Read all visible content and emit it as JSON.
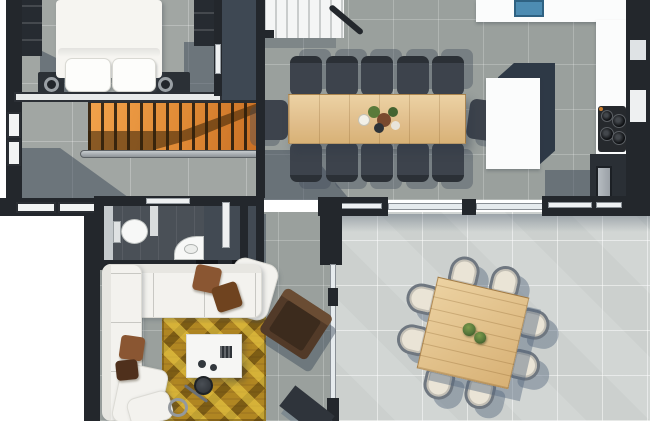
{
  "image": {
    "kind": "architectural-floor-plan-render",
    "view": "top-down",
    "description": "Open-plan home level rendered from above: bedroom, orange staircase, long dining table, kitchen, bathroom, living room with gold rug, and a bright great room with a square table."
  },
  "colors": {
    "outside": "#ffffff",
    "wall": "#23272c",
    "floor_concrete": "#a1a6a3",
    "floor_tile_gray": "#9aa09d",
    "floor_tile_light": "#d2d6d4",
    "floor_slate": "#3e4853",
    "shadow_slate": "rgba(55,67,83,0.5)",
    "stair_wood": "#e08a35",
    "white_stairs": "#f4f5f5",
    "table_wood": "#e0bd8a",
    "chair_dark": "#3d434c",
    "chair_cream": "#eae4d6",
    "chair_frame": "#6f7780",
    "sofa": "#f3f2ee",
    "pillow_brown": "#8a5632",
    "pillow_dark_brown": "#4f301c",
    "rug_gold": "#b08622",
    "armchair_brown": "#523a28",
    "counter": "#fbfcfc",
    "island_shadow": "#2e3946",
    "sink_blue": "#4d8cb2",
    "cooktop": "#26292d",
    "steel": "#b6bcc1",
    "bed_linen": "#f6f5f1",
    "plant_green": "#56763a"
  },
  "rooms": [
    {
      "name": "bedroom",
      "position": "top-left",
      "furniture": [
        "double-bed",
        "two-pillows",
        "two-nightstands-with-lamps",
        "wardrobe",
        "closet"
      ]
    },
    {
      "name": "stair-hall",
      "position": "left",
      "furniture": [
        "orange-wood-staircase",
        "dark-balusters",
        "steel-handrail"
      ]
    },
    {
      "name": "upper-landing",
      "position": "top-center",
      "furniture": [
        "white-staircase",
        "dark-railing"
      ]
    },
    {
      "name": "dining-area",
      "position": "top-center",
      "furniture": [
        "long-rectangular-wood-table",
        "twelve-dark-chairs",
        "flower-centerpiece"
      ]
    },
    {
      "name": "kitchen",
      "position": "top-right",
      "furniture": [
        "wall-counter",
        "blue-sink",
        "white-island",
        "four-burner-cooktop",
        "tall-dark-cabinet"
      ]
    },
    {
      "name": "bathroom",
      "position": "center-left",
      "furniture": [
        "toilet",
        "corner-washbasin",
        "door"
      ]
    },
    {
      "name": "hall-closet",
      "position": "center",
      "furniture": [
        "white-door"
      ]
    },
    {
      "name": "living-room",
      "position": "bottom-left",
      "furniture": [
        "white-corner-sofa",
        "brown-cushions",
        "gold-diamond-rug",
        "white-coffee-table",
        "arc-floor-lamp",
        "white-lounge-chaise"
      ]
    },
    {
      "name": "great-room",
      "position": "bottom-right",
      "furniture": [
        "square-wood-table",
        "eight-cream-chairs",
        "two-potted-plants",
        "glass-partition",
        "brown-armchair",
        "dark-media-piece"
      ]
    }
  ],
  "furniture_counts": {
    "dining_chairs": 12,
    "great_room_chairs": 8,
    "cooktop_burners": 4,
    "bed_pillows": 2,
    "sofa_cushions": 4,
    "windows_left_wall": 2,
    "windows_bottom_wall": 2,
    "plants_on_square_table": 2
  }
}
